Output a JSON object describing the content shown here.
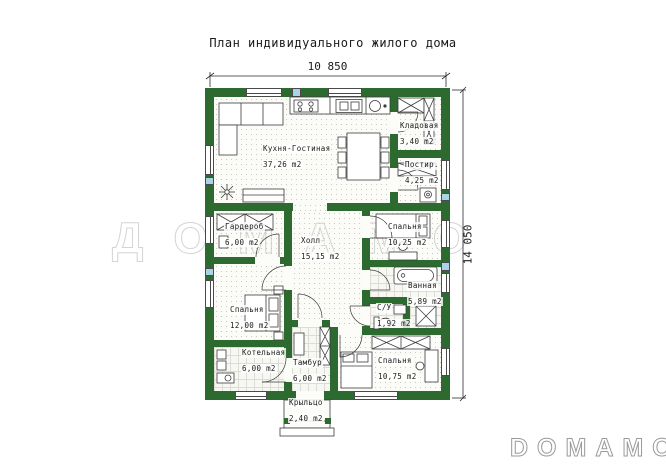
{
  "title": "План индивидуального жилого дома",
  "dimensions": {
    "top": "10 850",
    "right": "14 050",
    "porch_width": "2,40 m2"
  },
  "watermarks": {
    "center": "ДОМАМО",
    "logo": "DOMAMO"
  },
  "colors": {
    "wall": "#2d6a2f",
    "window_glass": "#a9d4e8",
    "floor": "#fbfbf8"
  },
  "rooms": [
    {
      "id": "kitchen-living",
      "name": "Кухня-Гостиная",
      "area": "37,26 m2"
    },
    {
      "id": "pantry",
      "name": "Кладовая",
      "area": "3,40 m2"
    },
    {
      "id": "laundry",
      "name": "Постир.",
      "area": "4,25 m2"
    },
    {
      "id": "wardrobe",
      "name": "Гардероб",
      "area": "6,00 m2"
    },
    {
      "id": "hall",
      "name": "Холл",
      "area": "15,15 m2"
    },
    {
      "id": "bedroom-right-top",
      "name": "Спальня",
      "area": "10,25 m2"
    },
    {
      "id": "bathroom",
      "name": "Ванная",
      "area": "5,89 m2"
    },
    {
      "id": "wc",
      "name": "С/У",
      "area": "1,92 m2"
    },
    {
      "id": "bedroom-left",
      "name": "Спальня",
      "area": "12,00 m2"
    },
    {
      "id": "boiler-room",
      "name": "Котельная",
      "area": "6,00 m2"
    },
    {
      "id": "vestibule",
      "name": "Тамбур",
      "area": "6,00 m2"
    },
    {
      "id": "bedroom-right-bottom",
      "name": "Спальня",
      "area": "10,75 m2"
    },
    {
      "id": "porch",
      "name": "Крыльцо",
      "area": "2,40 m2"
    }
  ]
}
